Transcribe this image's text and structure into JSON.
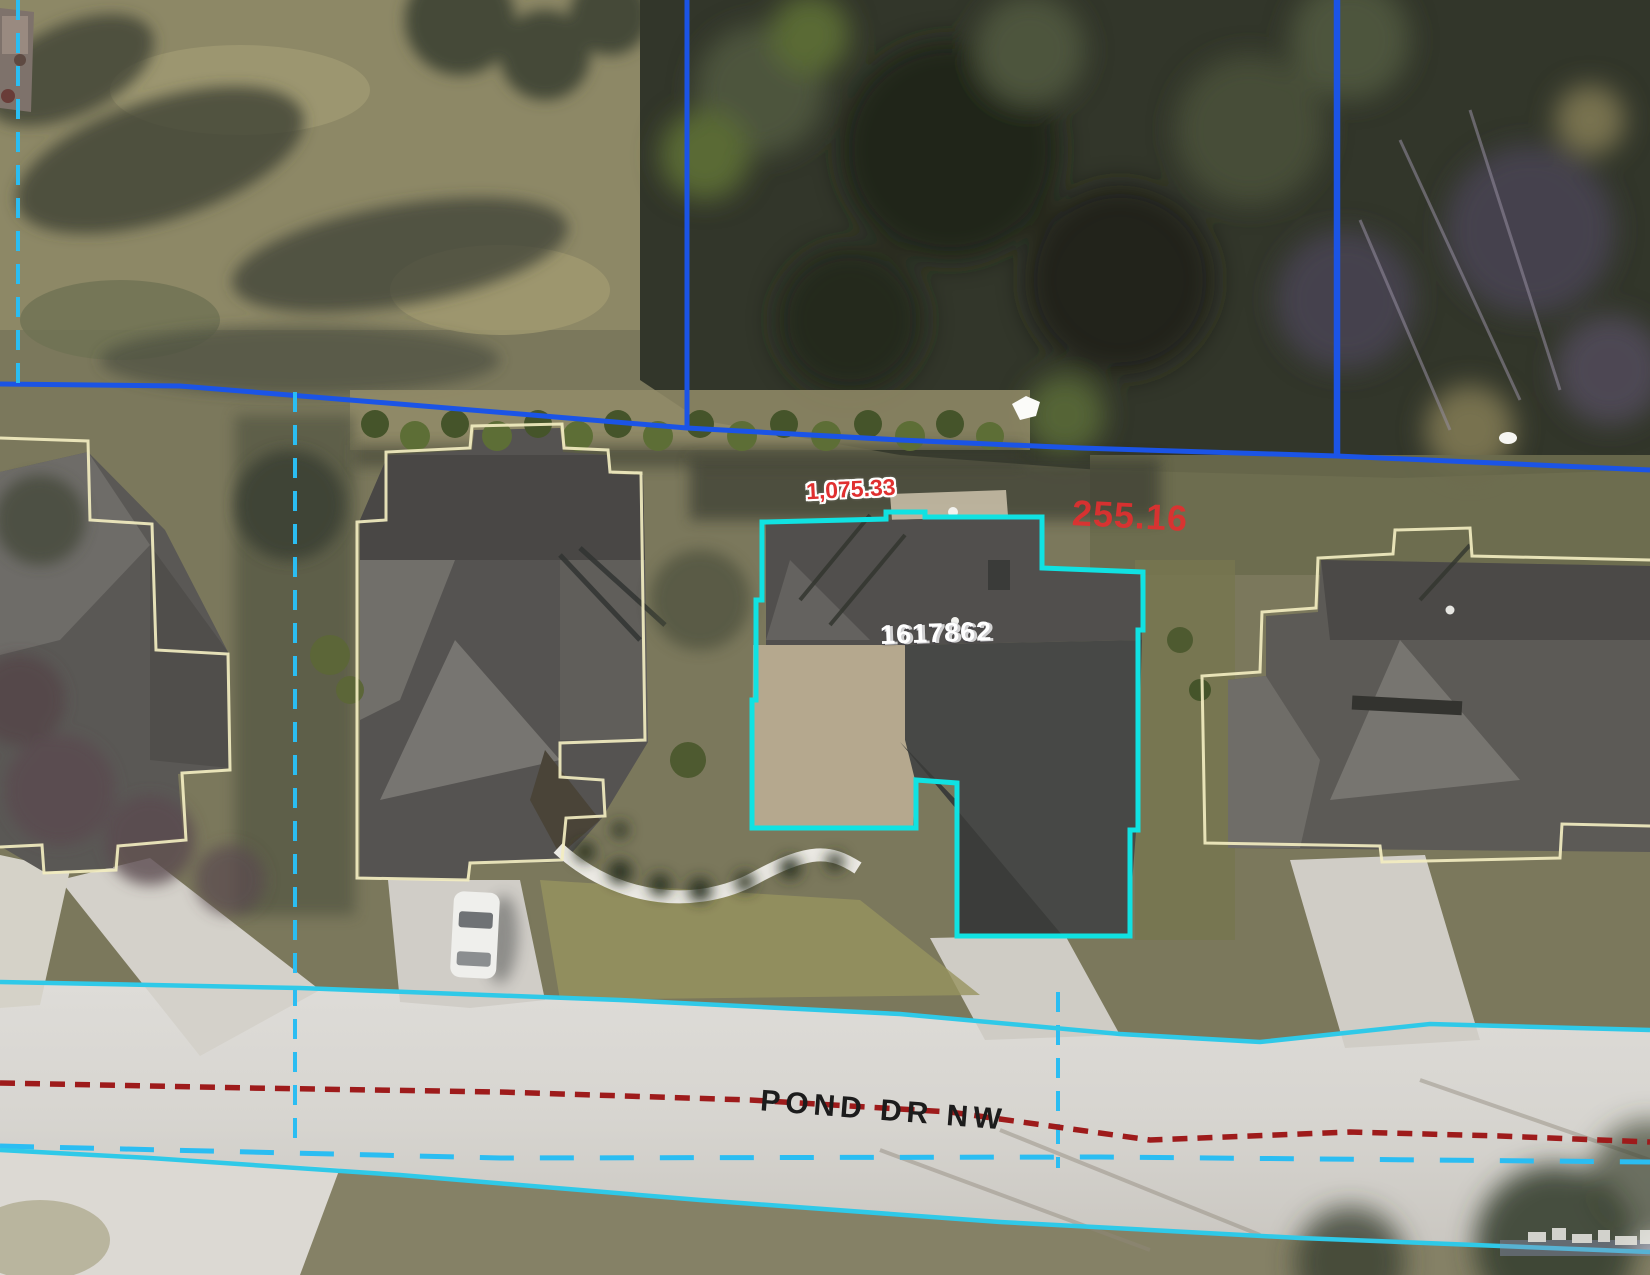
{
  "map": {
    "labels": {
      "lot_line_dimension_top": "1,075.33",
      "lot_line_dimension_right": "255.16",
      "parcel_number": "1617862",
      "street_name": "POND DR NW"
    },
    "colors": {
      "parcel_highlight": "#10E2E2",
      "parcel_boundary_blue": "#1B54E6",
      "easement_cyan_dashed": "#2BBDF2",
      "road_edge_cyan": "#2FC9E8",
      "road_centerline_red": "#9E1B1B",
      "building_outline_yellow": "#F2EDC0",
      "dimension_text_red": "#E03030",
      "parcel_text_white": "#FFFFFF",
      "street_text_black": "#1C1C1C"
    }
  }
}
